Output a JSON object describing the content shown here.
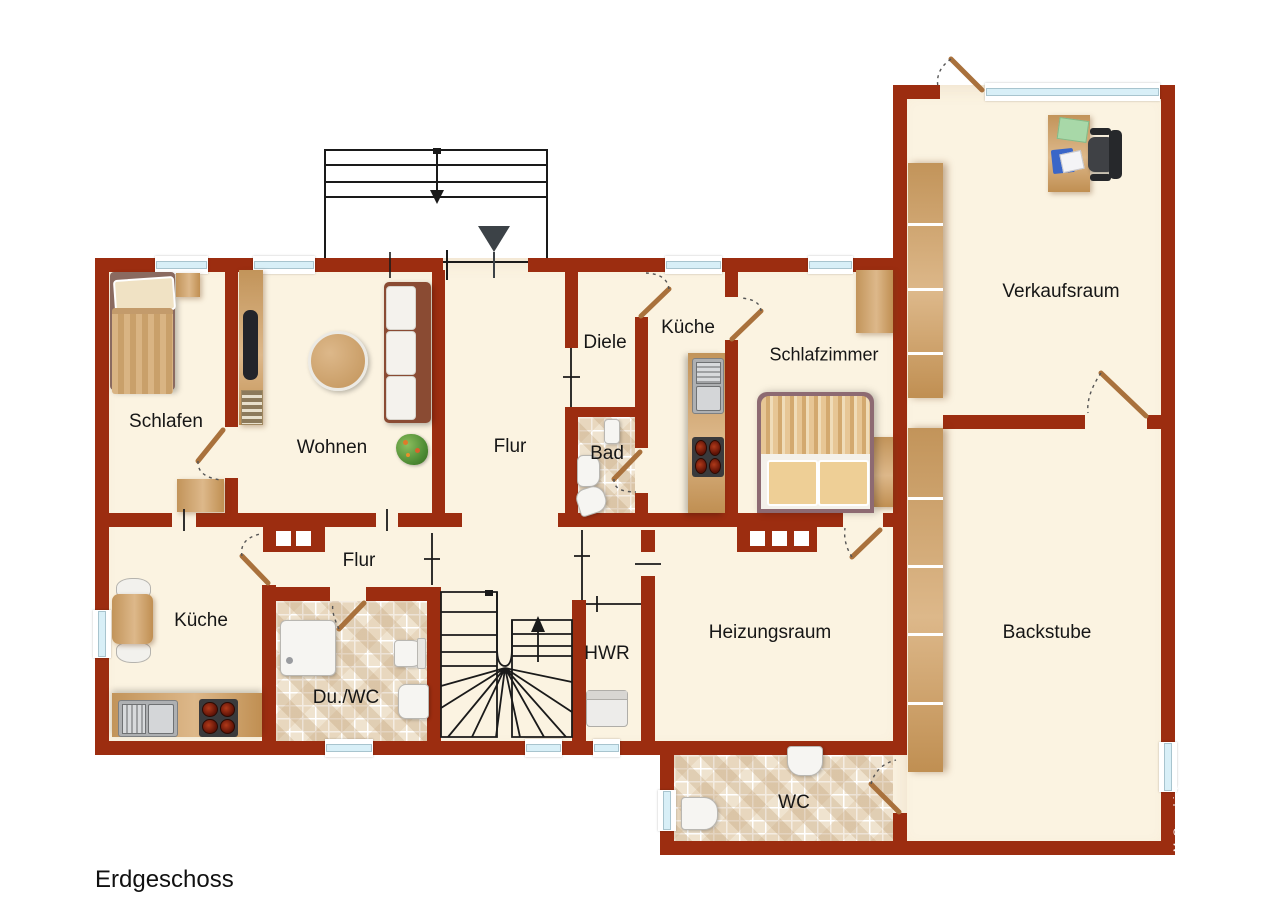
{
  "plan": {
    "title": "Erdgeschoss",
    "watermark": "McGrundriss"
  },
  "rooms": {
    "schlafen": {
      "label": "Schlafen"
    },
    "wohnen": {
      "label": "Wohnen"
    },
    "flur_upper": {
      "label": "Flur"
    },
    "diele": {
      "label": "Diele"
    },
    "bad": {
      "label": "Bad"
    },
    "kueche_upper": {
      "label": "Küche"
    },
    "schlafzimmer": {
      "label": "Schlafzimmer"
    },
    "kueche_lower": {
      "label": "Küche"
    },
    "flur_lower": {
      "label": "Flur"
    },
    "du_wc": {
      "label": "Du./WC"
    },
    "hwr": {
      "label": "HWR"
    },
    "heizungsraum": {
      "label": "Heizungsraum"
    },
    "wc": {
      "label": "WC"
    },
    "verkaufsraum": {
      "label": "Verkaufsraum"
    },
    "backstube": {
      "label": "Backstube"
    }
  },
  "icons": {
    "entrance_marker": "down-triangle",
    "stair_up_arrow": "arrow-up",
    "outdoor_stair_down_arrow": "arrow-down"
  },
  "colors": {
    "wall": "#9C2D10",
    "floor": "#FBF3E1",
    "glass": "#D8EFF7",
    "door_wood": "#A9713C",
    "furn_wood": "#CFA36B",
    "label": "#161616",
    "lines": "#1A1A1A",
    "fixture": "#F6F5F2"
  }
}
